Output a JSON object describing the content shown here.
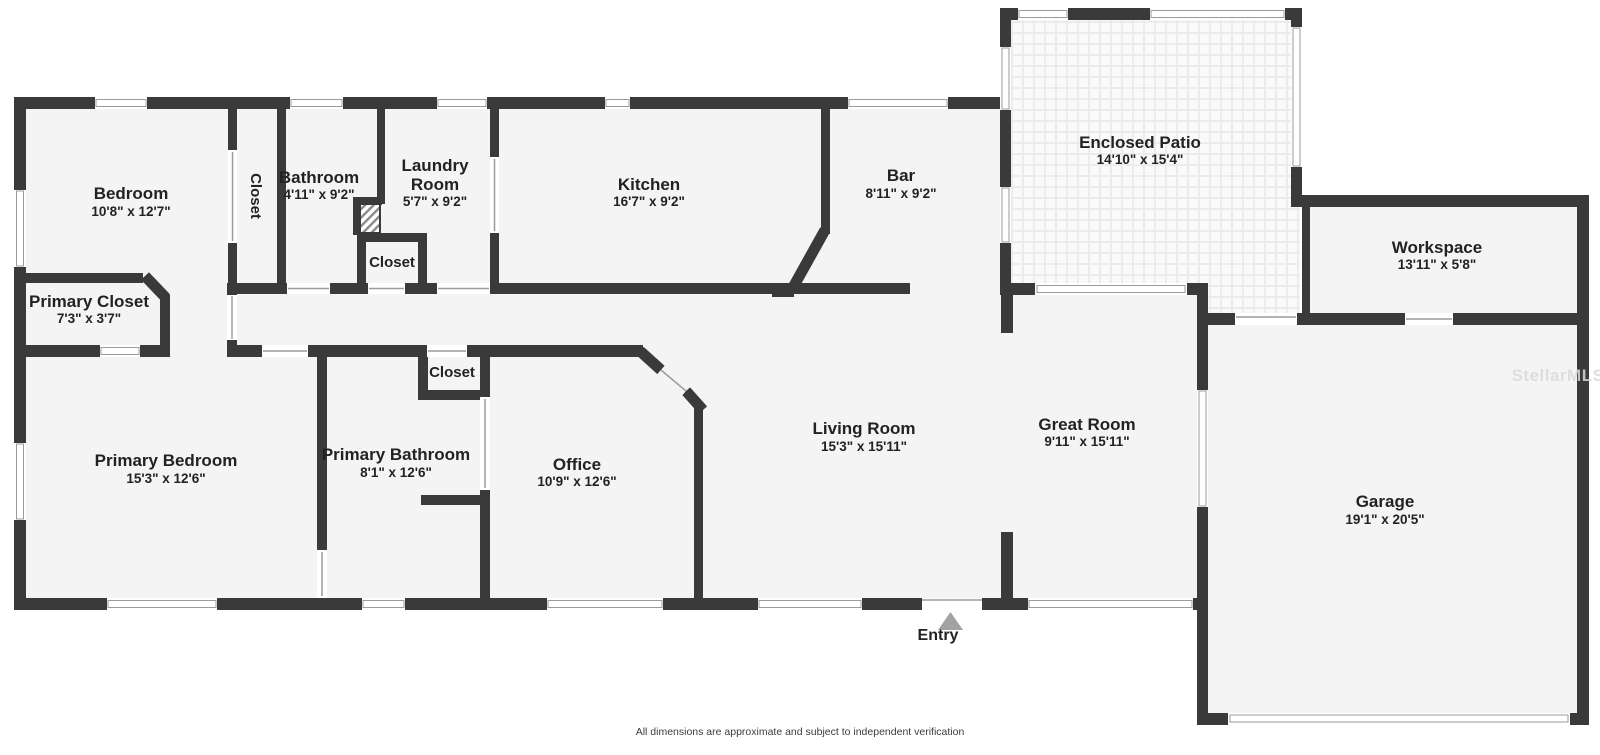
{
  "floorplan": {
    "rooms": [
      {
        "name": "Bedroom",
        "dimensions": "10'8\" x 12'7\""
      },
      {
        "name": "Closet"
      },
      {
        "name": "Bathroom",
        "dimensions": "4'11\" x 9'2\""
      },
      {
        "name": "Laundry Room",
        "name_lines": [
          "Laundry",
          "Room"
        ],
        "dimensions": "5'7\" x 9'2\""
      },
      {
        "name": "Closet"
      },
      {
        "name": "Kitchen",
        "dimensions": "16'7\" x 9'2\""
      },
      {
        "name": "Bar",
        "dimensions": "8'11\" x 9'2\""
      },
      {
        "name": "Enclosed Patio",
        "dimensions": "14'10\" x 15'4\""
      },
      {
        "name": "Workspace",
        "dimensions": "13'11\" x 5'8\""
      },
      {
        "name": "Primary Closet",
        "dimensions": "7'3\" x 3'7\""
      },
      {
        "name": "Primary Bedroom",
        "dimensions": "15'3\" x 12'6\""
      },
      {
        "name": "Primary Bathroom",
        "dimensions": "8'1\" x 12'6\""
      },
      {
        "name": "Closet"
      },
      {
        "name": "Office",
        "dimensions": "10'9\" x 12'6\""
      },
      {
        "name": "Living Room",
        "dimensions": "15'3\" x 15'11\""
      },
      {
        "name": "Great Room",
        "dimensions": "9'11\" x 15'11\""
      },
      {
        "name": "Garage",
        "dimensions": "19'1\" x 20'5\""
      }
    ],
    "entry_label": "Entry",
    "watermark": "StellarMLS",
    "footer": "All dimensions are approximate and subject to independent verification",
    "colors": {
      "wall": "#3a3a3a",
      "floor": "#f4f4f4",
      "background": "#ffffff",
      "line": "#9b9b9b",
      "entry_arrow": "#a3a3a3",
      "watermark": "#d9d9d9",
      "text": "#222222"
    }
  }
}
